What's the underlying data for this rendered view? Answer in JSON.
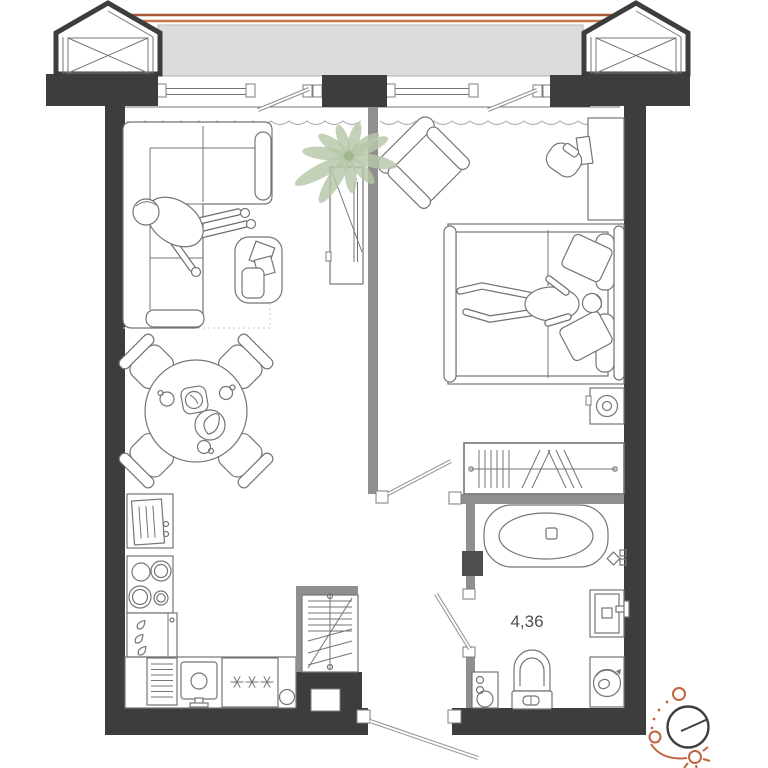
{
  "plan": {
    "type": "apartment-floor-plan",
    "colors": {
      "wall": "#3d3d3d",
      "partition": "#8f8f8f",
      "balcony": "#dcdcdc",
      "line": "#757575",
      "line_light": "#a9aeae",
      "accent_top": "#a55c36",
      "accent_bottom": "#c6794e",
      "plant": "#b6c7a9",
      "plant_dark": "#9cb28b",
      "compass_orange": "#c06540",
      "text": "#4f4f4f"
    },
    "rooms": {
      "balcony": {
        "name": "balcony",
        "features": [
          "glazed-front",
          "bay-window-left",
          "bay-window-right",
          "balcony-rail-lines"
        ]
      },
      "living_room": {
        "furniture": [
          "corner-sofa",
          "person-sitting",
          "coffee-table",
          "decor-books",
          "tv-cabinet",
          "rug-outline",
          "dining-table",
          "dining-chairs-x4",
          "tableware",
          "plant"
        ]
      },
      "kitchen": {
        "furniture": [
          "oven-unit",
          "cooktop-4-burners",
          "dishwasher",
          "drying-rack",
          "sink",
          "fridge-freezer",
          "stool"
        ]
      },
      "bedroom": {
        "furniture": [
          "armchair",
          "desk",
          "desk-chair",
          "monitor",
          "double-bed",
          "pillows-x4",
          "person-lying",
          "speaker-unit",
          "wardrobe-with-hangers"
        ]
      },
      "bathroom": {
        "area_label": "4,36",
        "furniture": [
          "bathtub",
          "washbasin",
          "toilet",
          "water-heater",
          "washing-machine"
        ]
      },
      "hallway": {
        "features": [
          "vent-shaft",
          "entrance-door"
        ]
      }
    },
    "icons": {
      "compass": "sun-path-compass-icon"
    }
  }
}
